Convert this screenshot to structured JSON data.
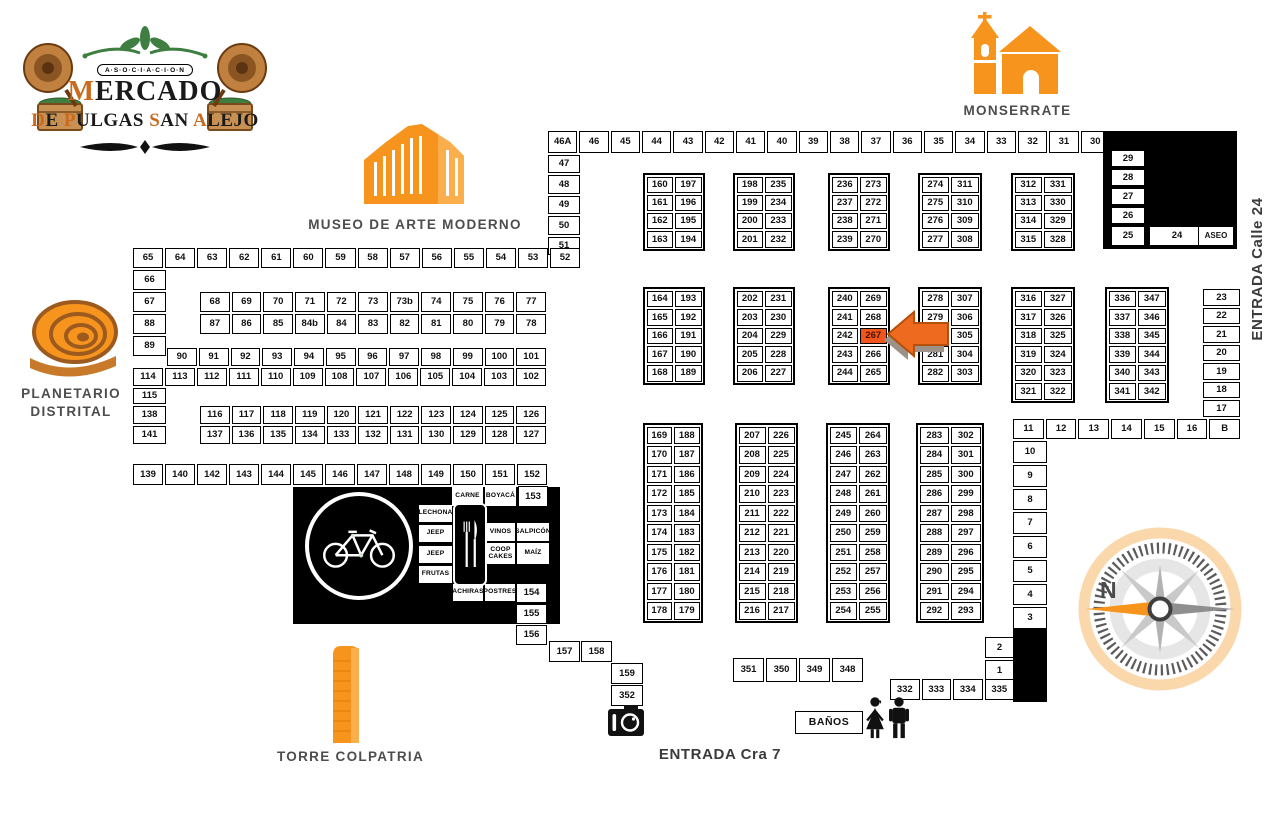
{
  "logo": {
    "badge": "A·S·O·C·I·A·C·I·O·N",
    "title": "MERCADO",
    "subtitle": "DE PULGAS SAN ALEJO"
  },
  "landmarks": {
    "monserrate": "MONSERRATE",
    "museo": "MUSEO DE ARTE MODERNO",
    "planetario_line1": "PLANETARIO",
    "planetario_line2": "DISTRITAL",
    "torre": "TORRE COLPATRIA",
    "entrada_calle24": "ENTRADA Calle 24",
    "entrada_cra7": "ENTRADA Cra 7"
  },
  "compass": {
    "north": "N"
  },
  "highlight_stall": "267",
  "colors": {
    "accent": "#F7941E",
    "accent_light": "#FBAE4C",
    "highlight": "#F0551D",
    "label": "#4D4D4F",
    "green": "#3E7E41",
    "black": "#000000"
  },
  "rows": {
    "top": [
      "46A",
      "46",
      "45",
      "44",
      "43",
      "42",
      "41",
      "40",
      "39",
      "38",
      "37",
      "36",
      "35",
      "34",
      "33",
      "32",
      "31",
      "30"
    ],
    "r65": [
      "65",
      "64",
      "63",
      "62",
      "61",
      "60",
      "59",
      "58",
      "57",
      "56",
      "55",
      "54",
      "53",
      "52"
    ],
    "r68": [
      "68",
      "69",
      "70",
      "71",
      "72",
      "73",
      "73b",
      "74",
      "75",
      "76",
      "77"
    ],
    "r87": [
      "87",
      "86",
      "85",
      "84b",
      "84",
      "83",
      "82",
      "81",
      "80",
      "79",
      "78"
    ],
    "r90": [
      "90",
      "91",
      "92",
      "93",
      "94",
      "95",
      "96",
      "97",
      "98",
      "99",
      "100",
      "101"
    ],
    "r114": [
      "114",
      "113",
      "112",
      "111",
      "110",
      "109",
      "108",
      "107",
      "106",
      "105",
      "104",
      "103",
      "102"
    ],
    "r116": [
      "116",
      "117",
      "118",
      "119",
      "120",
      "121",
      "122",
      "123",
      "124",
      "125",
      "126"
    ],
    "r137": [
      "137",
      "136",
      "135",
      "134",
      "133",
      "132",
      "131",
      "130",
      "129",
      "128",
      "127"
    ],
    "r139": [
      "139",
      "140",
      "142",
      "143",
      "144",
      "145",
      "146",
      "147",
      "148",
      "149",
      "150",
      "151",
      "152"
    ],
    "r11": [
      "11",
      "12",
      "13",
      "14",
      "15",
      "16",
      "B"
    ],
    "r332": [
      "332",
      "333",
      "334",
      "335"
    ],
    "r351": [
      "351",
      "350",
      "349",
      "348"
    ]
  },
  "cols": {
    "c47": [
      "47",
      "48",
      "49",
      "50",
      "51"
    ],
    "c29": [
      "29",
      "28",
      "27",
      "26"
    ],
    "c66": [
      "66",
      "67",
      "88",
      "89"
    ],
    "c23": [
      "23",
      "22",
      "21",
      "20",
      "19",
      "18",
      "17"
    ],
    "c10": [
      "10",
      "9",
      "8",
      "7",
      "6",
      "5",
      "4",
      "3"
    ],
    "c2": [
      "2",
      "1"
    ]
  },
  "blocks": {
    "b160": [
      [
        "160",
        "197"
      ],
      [
        "161",
        "196"
      ],
      [
        "162",
        "195"
      ],
      [
        "163",
        "194"
      ]
    ],
    "b198": [
      [
        "198",
        "235"
      ],
      [
        "199",
        "234"
      ],
      [
        "200",
        "233"
      ],
      [
        "201",
        "232"
      ]
    ],
    "b236": [
      [
        "236",
        "273"
      ],
      [
        "237",
        "272"
      ],
      [
        "238",
        "271"
      ],
      [
        "239",
        "270"
      ]
    ],
    "b274": [
      [
        "274",
        "311"
      ],
      [
        "275",
        "310"
      ],
      [
        "276",
        "309"
      ],
      [
        "277",
        "308"
      ]
    ],
    "b312": [
      [
        "312",
        "331"
      ],
      [
        "313",
        "330"
      ],
      [
        "314",
        "329"
      ],
      [
        "315",
        "328"
      ]
    ],
    "b164": [
      [
        "164",
        "193"
      ],
      [
        "165",
        "192"
      ],
      [
        "166",
        "191"
      ],
      [
        "167",
        "190"
      ],
      [
        "168",
        "189"
      ]
    ],
    "b202": [
      [
        "202",
        "231"
      ],
      [
        "203",
        "230"
      ],
      [
        "204",
        "229"
      ],
      [
        "205",
        "228"
      ],
      [
        "206",
        "227"
      ]
    ],
    "b240": [
      [
        "240",
        "269"
      ],
      [
        "241",
        "268"
      ],
      [
        "242",
        "267"
      ],
      [
        "243",
        "266"
      ],
      [
        "244",
        "265"
      ]
    ],
    "b278": [
      [
        "278",
        "307"
      ],
      [
        "279",
        "306"
      ],
      [
        "280",
        "305"
      ],
      [
        "281",
        "304"
      ],
      [
        "282",
        "303"
      ]
    ],
    "b316": [
      [
        "316",
        "327"
      ],
      [
        "317",
        "326"
      ],
      [
        "318",
        "325"
      ],
      [
        "319",
        "324"
      ],
      [
        "320",
        "323"
      ],
      [
        "321",
        "322"
      ]
    ],
    "b336": [
      [
        "336",
        "347"
      ],
      [
        "337",
        "346"
      ],
      [
        "338",
        "345"
      ],
      [
        "339",
        "344"
      ],
      [
        "340",
        "343"
      ],
      [
        "341",
        "342"
      ]
    ],
    "b169": [
      [
        "169",
        "188"
      ],
      [
        "170",
        "187"
      ],
      [
        "171",
        "186"
      ],
      [
        "172",
        "185"
      ],
      [
        "173",
        "184"
      ],
      [
        "174",
        "183"
      ],
      [
        "175",
        "182"
      ],
      [
        "176",
        "181"
      ],
      [
        "177",
        "180"
      ],
      [
        "178",
        "179"
      ]
    ],
    "b207": [
      [
        "207",
        "226"
      ],
      [
        "208",
        "225"
      ],
      [
        "209",
        "224"
      ],
      [
        "210",
        "223"
      ],
      [
        "211",
        "222"
      ],
      [
        "212",
        "221"
      ],
      [
        "213",
        "220"
      ],
      [
        "214",
        "219"
      ],
      [
        "215",
        "218"
      ],
      [
        "216",
        "217"
      ]
    ],
    "b245": [
      [
        "245",
        "264"
      ],
      [
        "246",
        "263"
      ],
      [
        "247",
        "262"
      ],
      [
        "248",
        "261"
      ],
      [
        "249",
        "260"
      ],
      [
        "250",
        "259"
      ],
      [
        "251",
        "258"
      ],
      [
        "252",
        "257"
      ],
      [
        "253",
        "256"
      ],
      [
        "254",
        "255"
      ]
    ],
    "b283": [
      [
        "283",
        "302"
      ],
      [
        "284",
        "301"
      ],
      [
        "285",
        "300"
      ],
      [
        "286",
        "299"
      ],
      [
        "287",
        "298"
      ],
      [
        "288",
        "297"
      ],
      [
        "289",
        "296"
      ],
      [
        "290",
        "295"
      ],
      [
        "291",
        "294"
      ],
      [
        "292",
        "293"
      ]
    ]
  },
  "cells": {
    "c115": "115",
    "c138": "138",
    "c141": "141",
    "c25": "25",
    "c24": "24",
    "aseo": "ASEO",
    "c153": "153",
    "c154": "154",
    "c155": "155",
    "c156": "156",
    "s157": "157",
    "s158": "158",
    "s159": "159",
    "s352": "352"
  },
  "food": {
    "carne": "CARNE",
    "boyaca": "BOYACÁ",
    "lechona": "LECHONA",
    "jeep1": "JEEP",
    "jeep2": "JEEP",
    "frutas": "FRUTAS",
    "vinos": "VINOS",
    "salpicon": "SALPICÓN",
    "coop": "COOP CAKES",
    "maiz": "MAÍZ",
    "achiras": "ACHIRAS",
    "postres": "POSTRES"
  },
  "banos": "BAÑOS",
  "icons": [
    "gramophone-icon",
    "leaf-flourish-icon",
    "scroll-flourish-icon",
    "church-icon",
    "museum-icon",
    "planetarium-icon",
    "tower-icon",
    "bicycle-icon",
    "utensils-icon",
    "camera-icon",
    "woman-icon",
    "man-icon",
    "compass-icon",
    "highlight-arrow-icon"
  ]
}
